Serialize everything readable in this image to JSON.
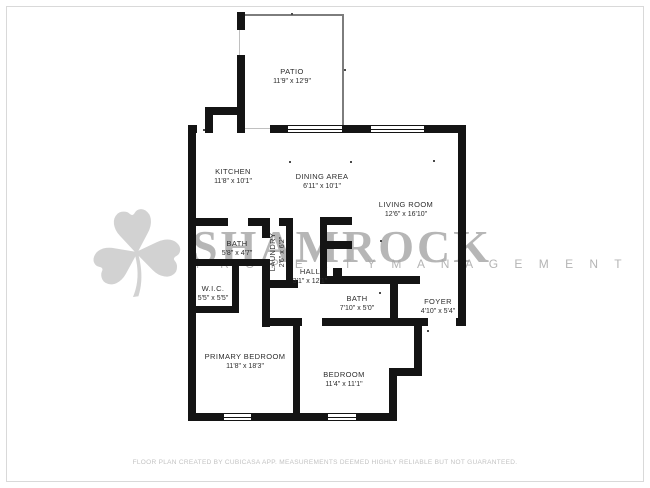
{
  "watermark": {
    "brand": "SHAMROCK",
    "tagline": "P R O P E R T Y   M A N A G E M E N T",
    "icon": "shamrock-icon",
    "glyph": "☘",
    "color": "#9e9e9e"
  },
  "footer": {
    "disclaimer": "FLOOR PLAN CREATED BY CUBICASA APP. MEASUREMENTS DEEMED HIGHLY RELIABLE BUT NOT GUARANTEED."
  },
  "colors": {
    "wall": "#141414",
    "background": "#ffffff",
    "frame_border": "#d9d9d9",
    "watermark_gray": "#a8a8a8"
  },
  "rooms": [
    {
      "name": "PATIO",
      "dimensions": "11'9\" x 12'9\""
    },
    {
      "name": "KITCHEN",
      "dimensions": "11'8\" x 10'1\""
    },
    {
      "name": "DINING AREA",
      "dimensions": "6'11\" x 10'1\""
    },
    {
      "name": "LIVING ROOM",
      "dimensions": "12'6\" x 16'10\""
    },
    {
      "name": "BATH",
      "dimensions": "5'8\" x 4'7\""
    },
    {
      "name": "LAUNDRY",
      "dimensions": "2'6\" x 6'2\""
    },
    {
      "name": "W.I.C.",
      "dimensions": "5'5\" x 5'5\""
    },
    {
      "name": "HALL",
      "dimensions": "3'1\" x 12'1\""
    },
    {
      "name": "BATH",
      "dimensions": "7'10\" x 5'0\""
    },
    {
      "name": "FOYER",
      "dimensions": "4'10\" x 5'4\""
    },
    {
      "name": "PRIMARY BEDROOM",
      "dimensions": "11'8\" x 18'3\""
    },
    {
      "name": "BEDROOM",
      "dimensions": "11'4\" x 11'1\""
    }
  ]
}
